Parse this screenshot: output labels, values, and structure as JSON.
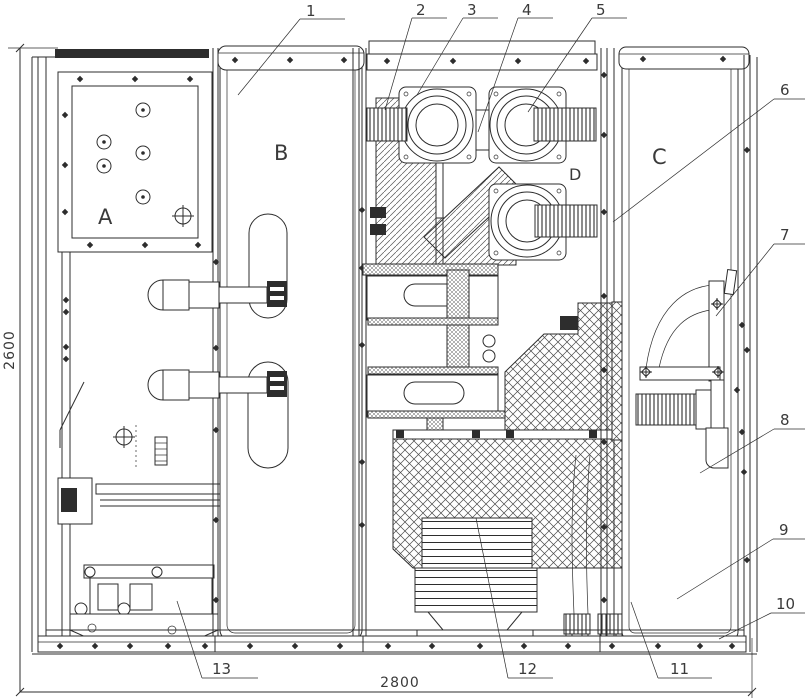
{
  "drawing": {
    "compartments": {
      "A": "A",
      "B": "B",
      "C": "C",
      "D": "D"
    },
    "callouts": [
      "1",
      "2",
      "3",
      "4",
      "5",
      "6",
      "7",
      "8",
      "9",
      "10",
      "11",
      "12",
      "13"
    ],
    "dimensions": {
      "height": "2600",
      "width": "2800"
    }
  }
}
